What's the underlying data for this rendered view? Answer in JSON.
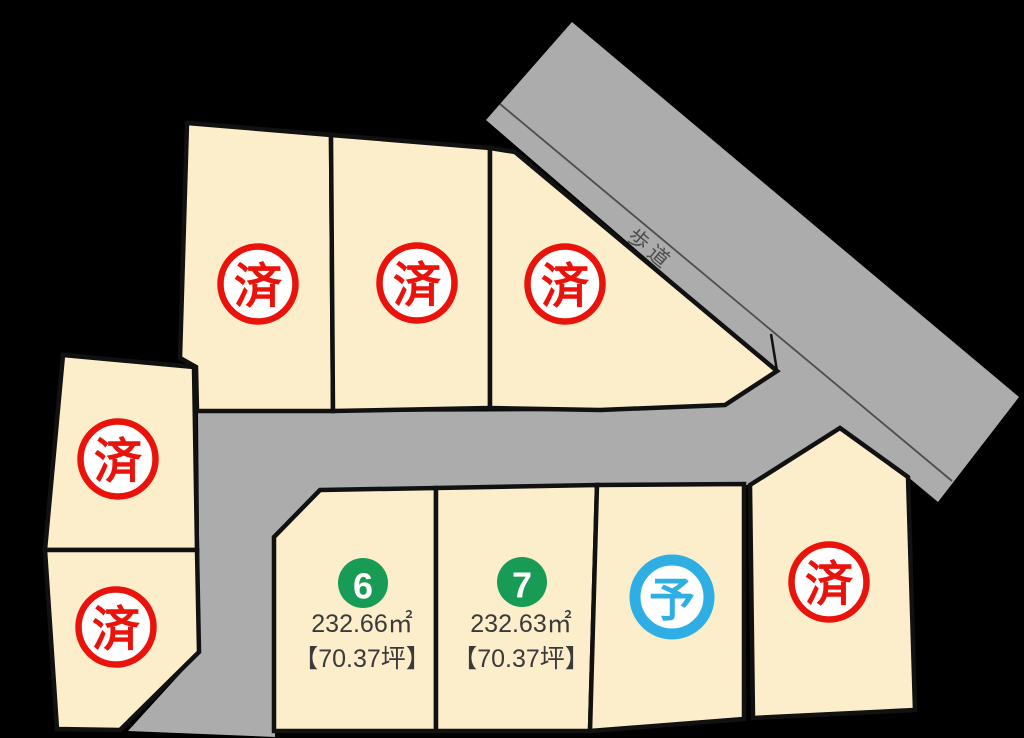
{
  "map_title": "land-lot-status-map",
  "road": {
    "label": "歩道"
  },
  "status_markers": {
    "sold": "済",
    "reserved": "予"
  },
  "colors": {
    "background": "#000000",
    "road": "#ACACAC",
    "road_divider": "#4D4D4D",
    "lot_fill": "#FCEECA",
    "lot_border": "#111111",
    "sold_red": "#E9130B",
    "reserved_blue": "#2FAEE3",
    "available_green": "#189B54",
    "stamp_bg": "#FFFFFF",
    "number_text": "#FFFFFF",
    "area_text": "#3A3A3A"
  },
  "lots": {
    "top_row": [
      {
        "name": "top-lot-1",
        "status": "sold",
        "marker": "済"
      },
      {
        "name": "top-lot-2",
        "status": "sold",
        "marker": "済"
      },
      {
        "name": "top-lot-3",
        "status": "sold",
        "marker": "済"
      }
    ],
    "left_column": [
      {
        "name": "left-lot-1",
        "status": "sold",
        "marker": "済"
      },
      {
        "name": "left-lot-2",
        "status": "sold",
        "marker": "済"
      }
    ],
    "bottom_row": [
      {
        "name": "lot-6",
        "number": "6",
        "area": "232.66㎡",
        "tsubo": "【70.37坪】",
        "status": "available"
      },
      {
        "name": "lot-7",
        "number": "7",
        "area": "232.63㎡",
        "tsubo": "【70.37坪】",
        "status": "available"
      },
      {
        "name": "lot-reserved",
        "status": "reserved",
        "marker": "予"
      },
      {
        "name": "lot-sold-bottom-right",
        "status": "sold",
        "marker": "済"
      }
    ]
  }
}
